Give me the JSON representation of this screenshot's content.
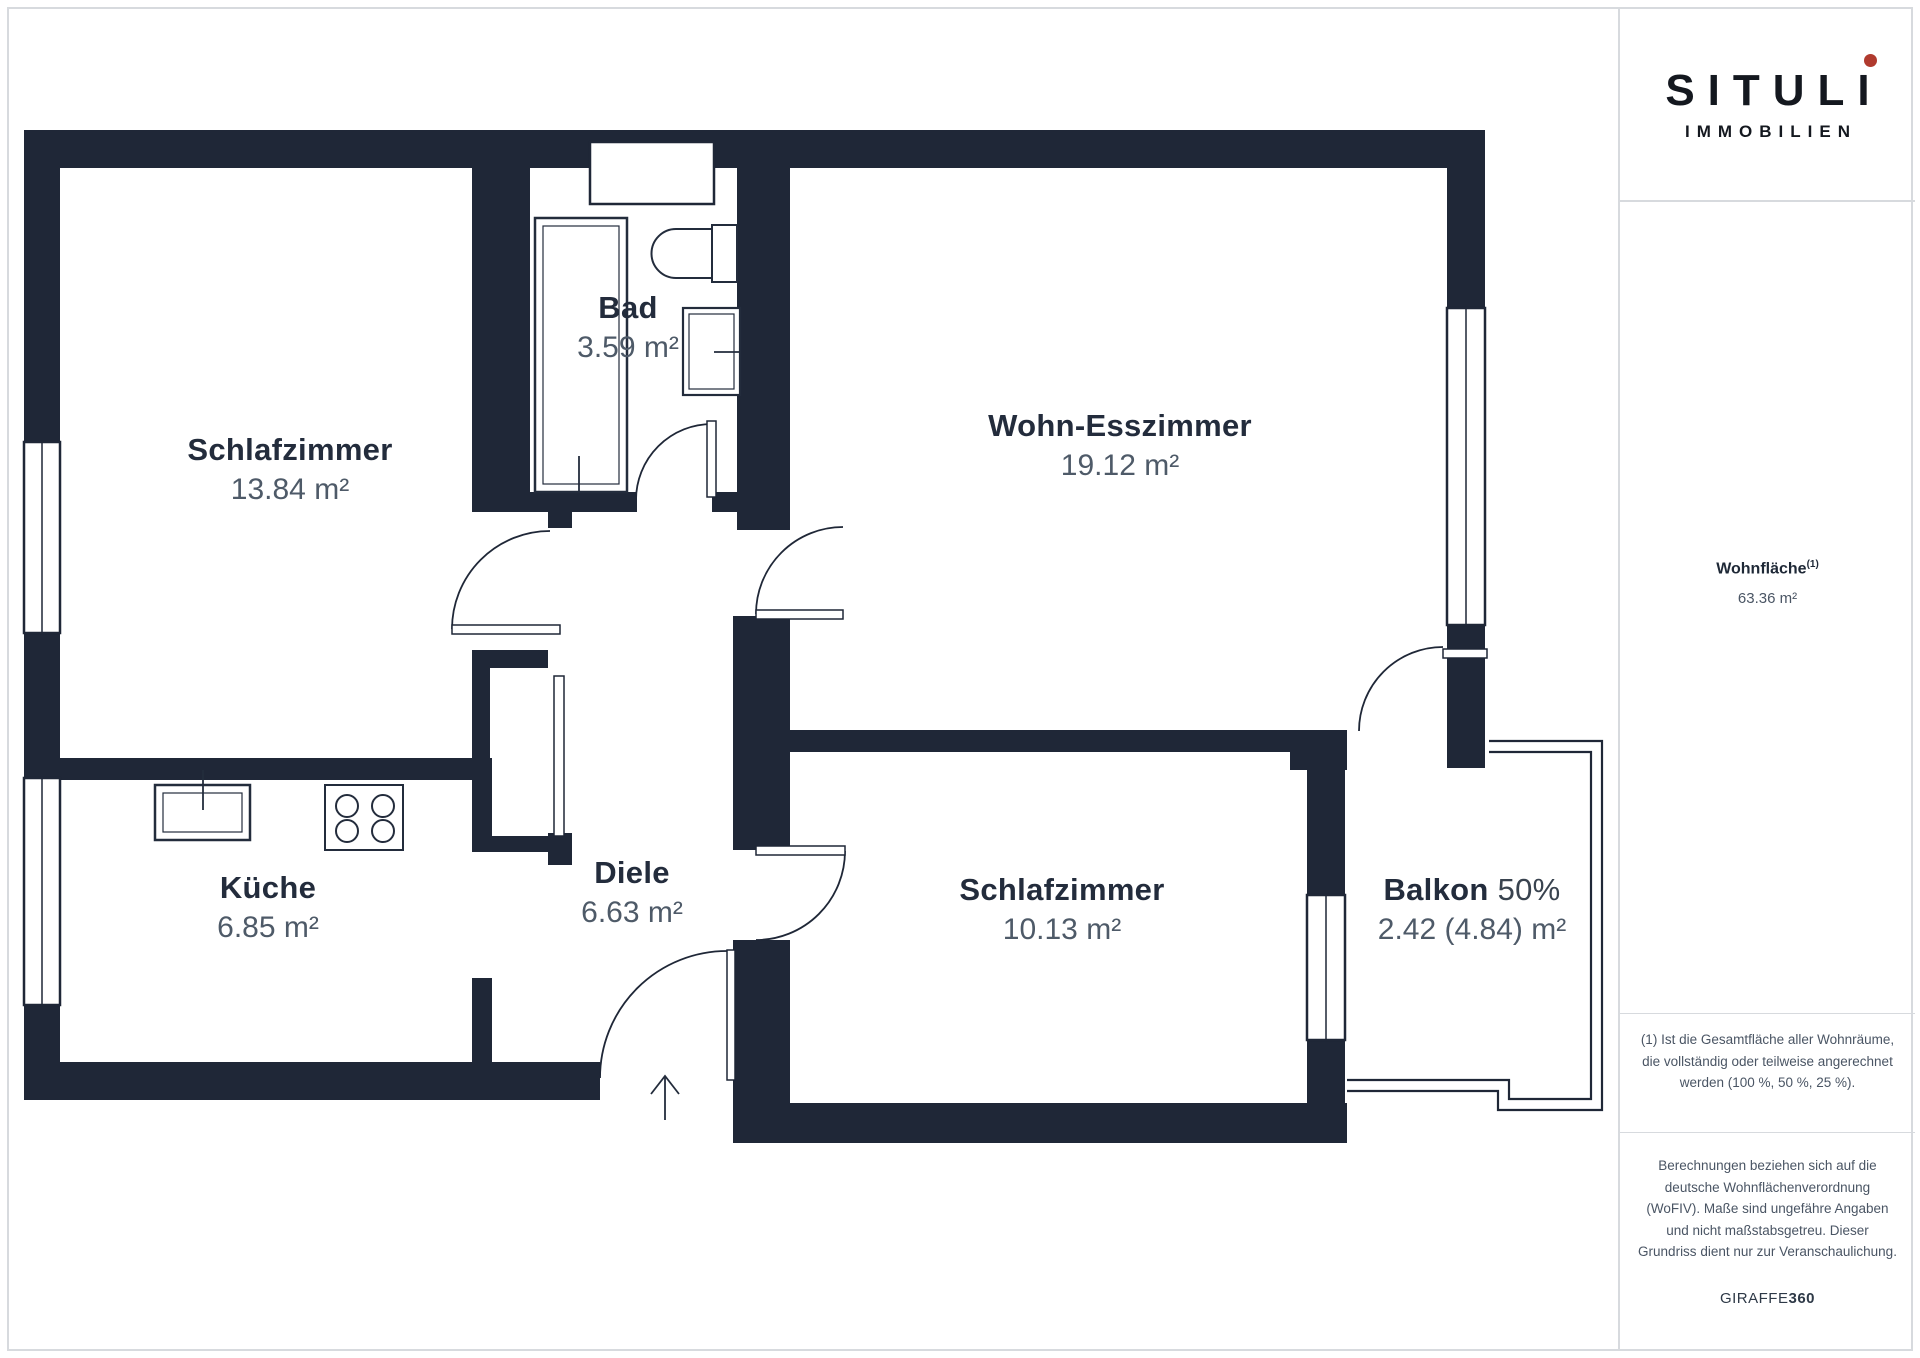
{
  "branding": {
    "logo_name": "SITULI",
    "logo_sub": "IMMOBILIEN",
    "logo_dot_color": "#b03a2e",
    "footer_brand": "GIRAFFE",
    "footer_brand_bold": "360"
  },
  "summary": {
    "label": "Wohnfläche",
    "superscript": "(1)",
    "value": "63.36 m²"
  },
  "notes": {
    "footnote": "(1) Ist die Gesamtfläche aller Wohnräume, die vollständig oder teilweise angerechnet werden (100 %, 50 %, 25 %).",
    "disclaimer": "Berechnungen beziehen sich auf die deutsche Wohnflächenverordnung (WoFIV). Maße sind ungefähre Angaben und nicht maßstabsgetreu. Dieser Grundriss dient nur zur Veranschaulichung."
  },
  "rooms": [
    {
      "id": "schlafzimmer-1",
      "name": "Schlafzimmer",
      "area": "13.84 m²"
    },
    {
      "id": "bad",
      "name": "Bad",
      "area": "3.59 m²"
    },
    {
      "id": "wohn-esszimmer",
      "name": "Wohn-Esszimmer",
      "area": "19.12 m²"
    },
    {
      "id": "kueche",
      "name": "Küche",
      "area": "6.85 m²"
    },
    {
      "id": "diele",
      "name": "Diele",
      "area": "6.63 m²"
    },
    {
      "id": "schlafzimmer-2",
      "name": "Schlafzimmer",
      "area": "10.13 m²"
    },
    {
      "id": "balkon",
      "name": "Balkon",
      "suffix": "50%",
      "area": "2.42 (4.84) m²"
    }
  ],
  "colors": {
    "wall": "#1f2737",
    "room_name": "#232c3c",
    "room_value": "#4e5a68",
    "frame_border": "#d7dade"
  }
}
